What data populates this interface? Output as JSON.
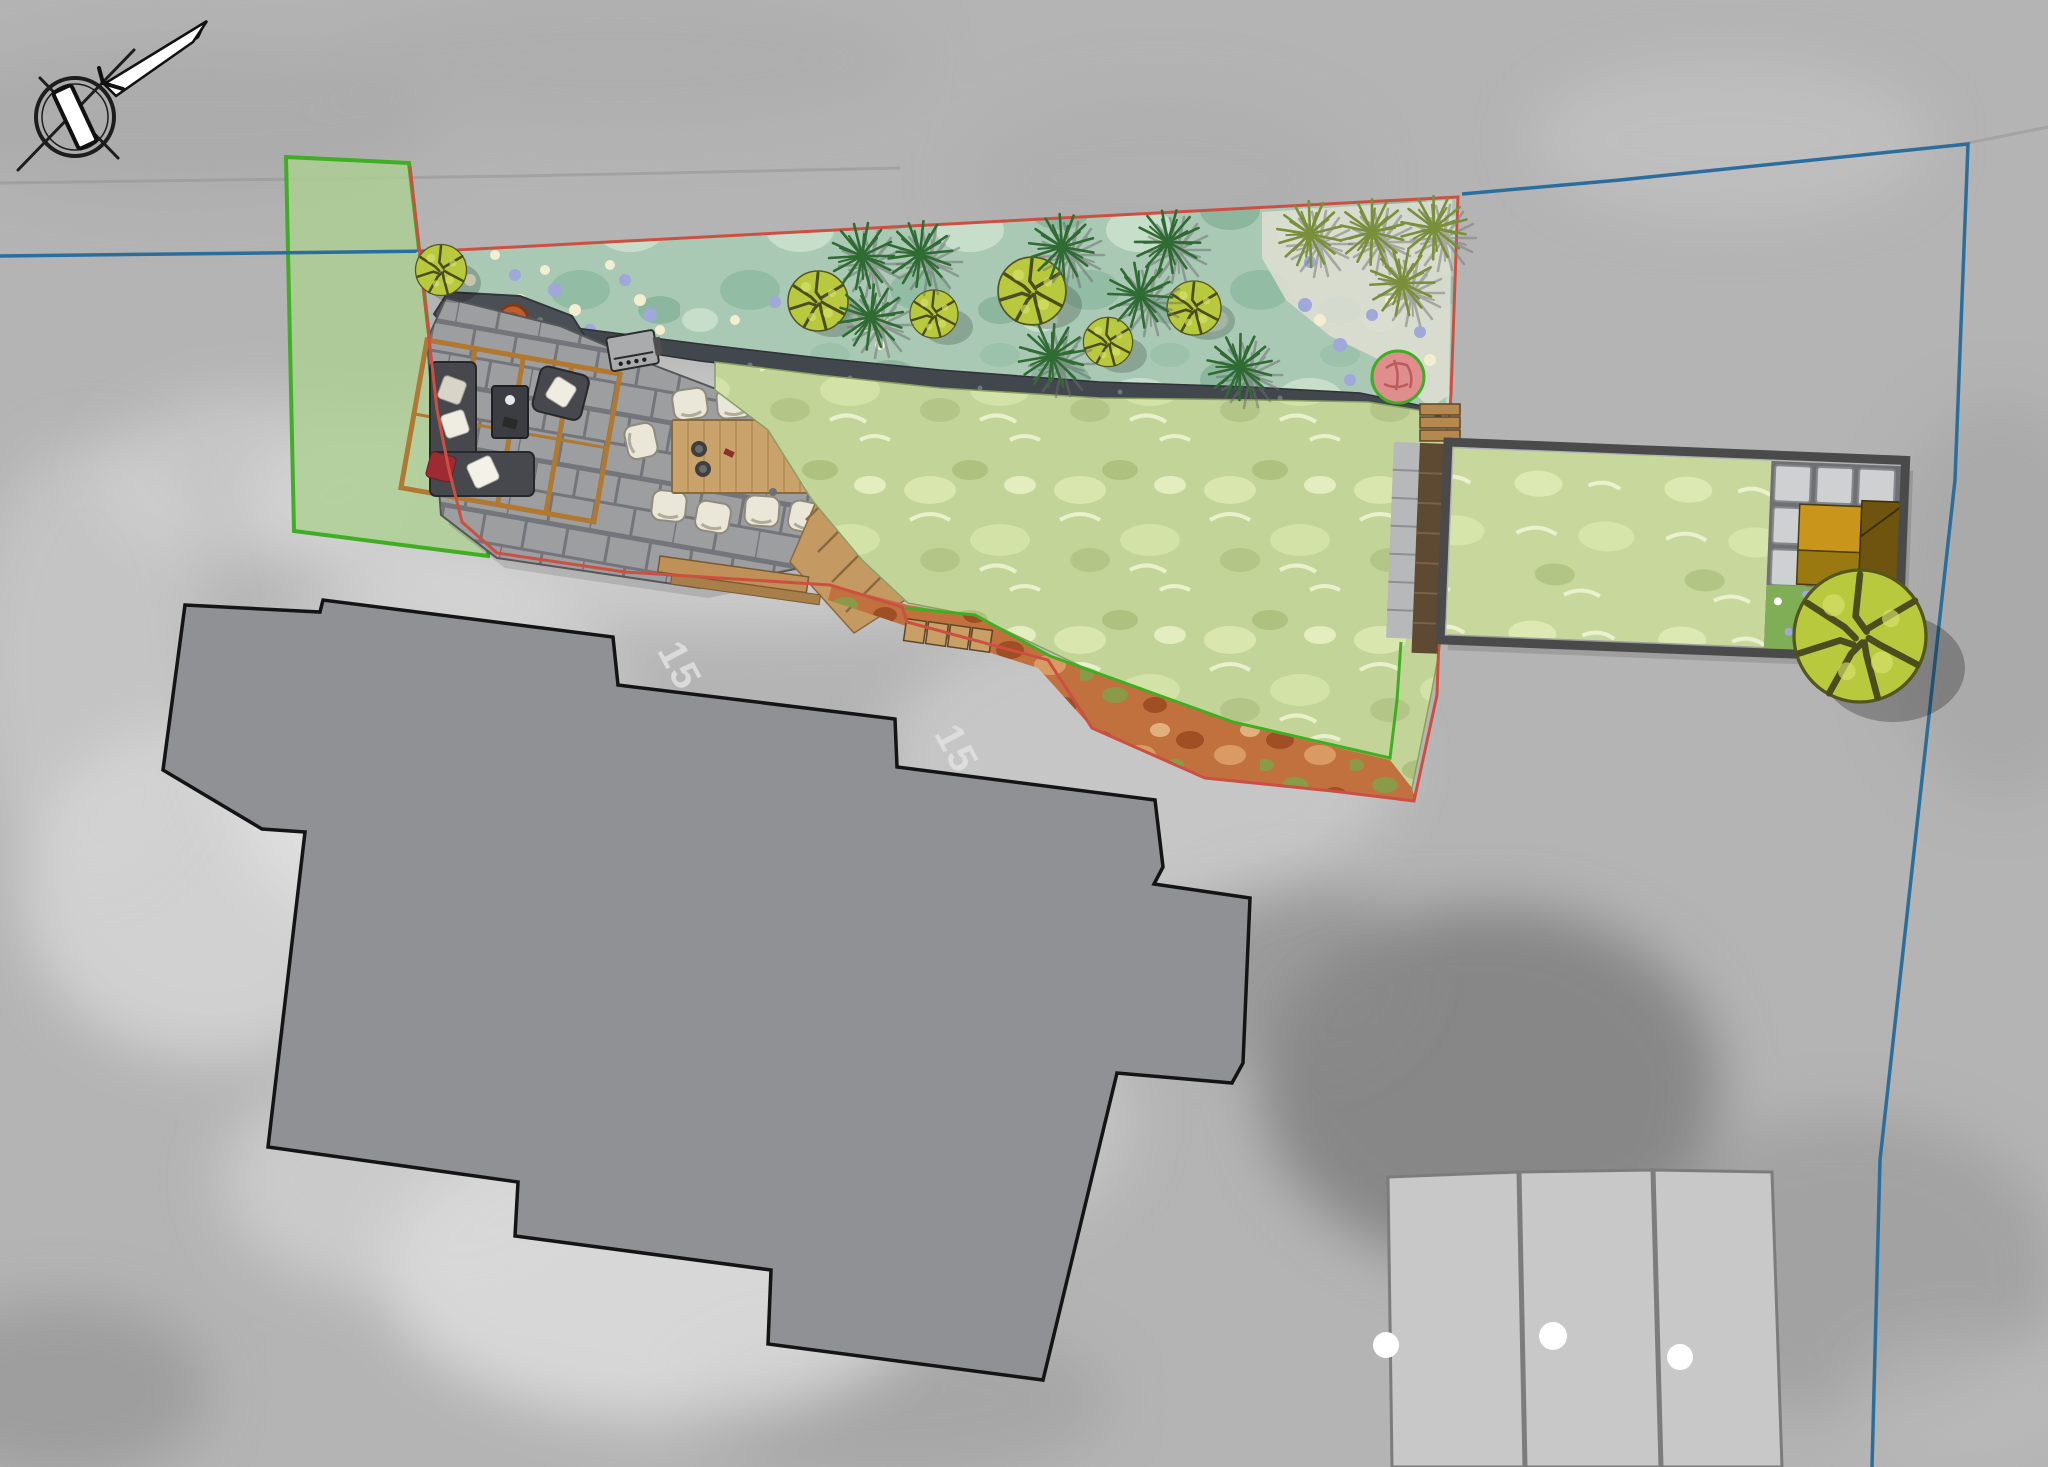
{
  "scene": {
    "type": "landscape-plan-over-aerial-photo",
    "compass_icon": "north-arrow-compass-icon",
    "photo_house_number_labels": [
      {
        "text": "15"
      },
      {
        "text": "15"
      }
    ]
  },
  "colors": {
    "photo_base": "#b4b4b4",
    "boundary_blue": "#2a6e9d",
    "boundary_red": "#cd4f42",
    "boundary_green": "#3fae22",
    "strip_fill": "#aecf92",
    "bed_fill": "#a9c9b4",
    "lawn_fill": "#c3d498",
    "lawn2_fill": "#c8d79b",
    "deck_gray": "#9c9ea0",
    "joint_gray": "#73757a",
    "rock_dark": "#42474d",
    "house_gray": "#8f9194",
    "house_outline": "#141414",
    "wood_tan": "#c49a62",
    "pergola_wood": "#b07830",
    "furniture_dark": "#46484e",
    "table_wood": "#c9a36b",
    "chair_cream": "#eae6d8",
    "shed_gold": "#c9951a",
    "shed_dark": "#6f5410",
    "tree_green": "#b9c93e",
    "tree_line": "#4c4d1e",
    "spiky_dark": "#2f6b33",
    "spiky_olive": "#7a8f3a",
    "firepit_orange": "#c05c2a",
    "pink_plant": "#df8d8d",
    "autumn_base": "#c0713d",
    "garage_light": "#c8c8c8",
    "dot_white": "#ffffff",
    "flower_blue": "#9fa8d8",
    "flower_cream": "#f2eecf"
  }
}
